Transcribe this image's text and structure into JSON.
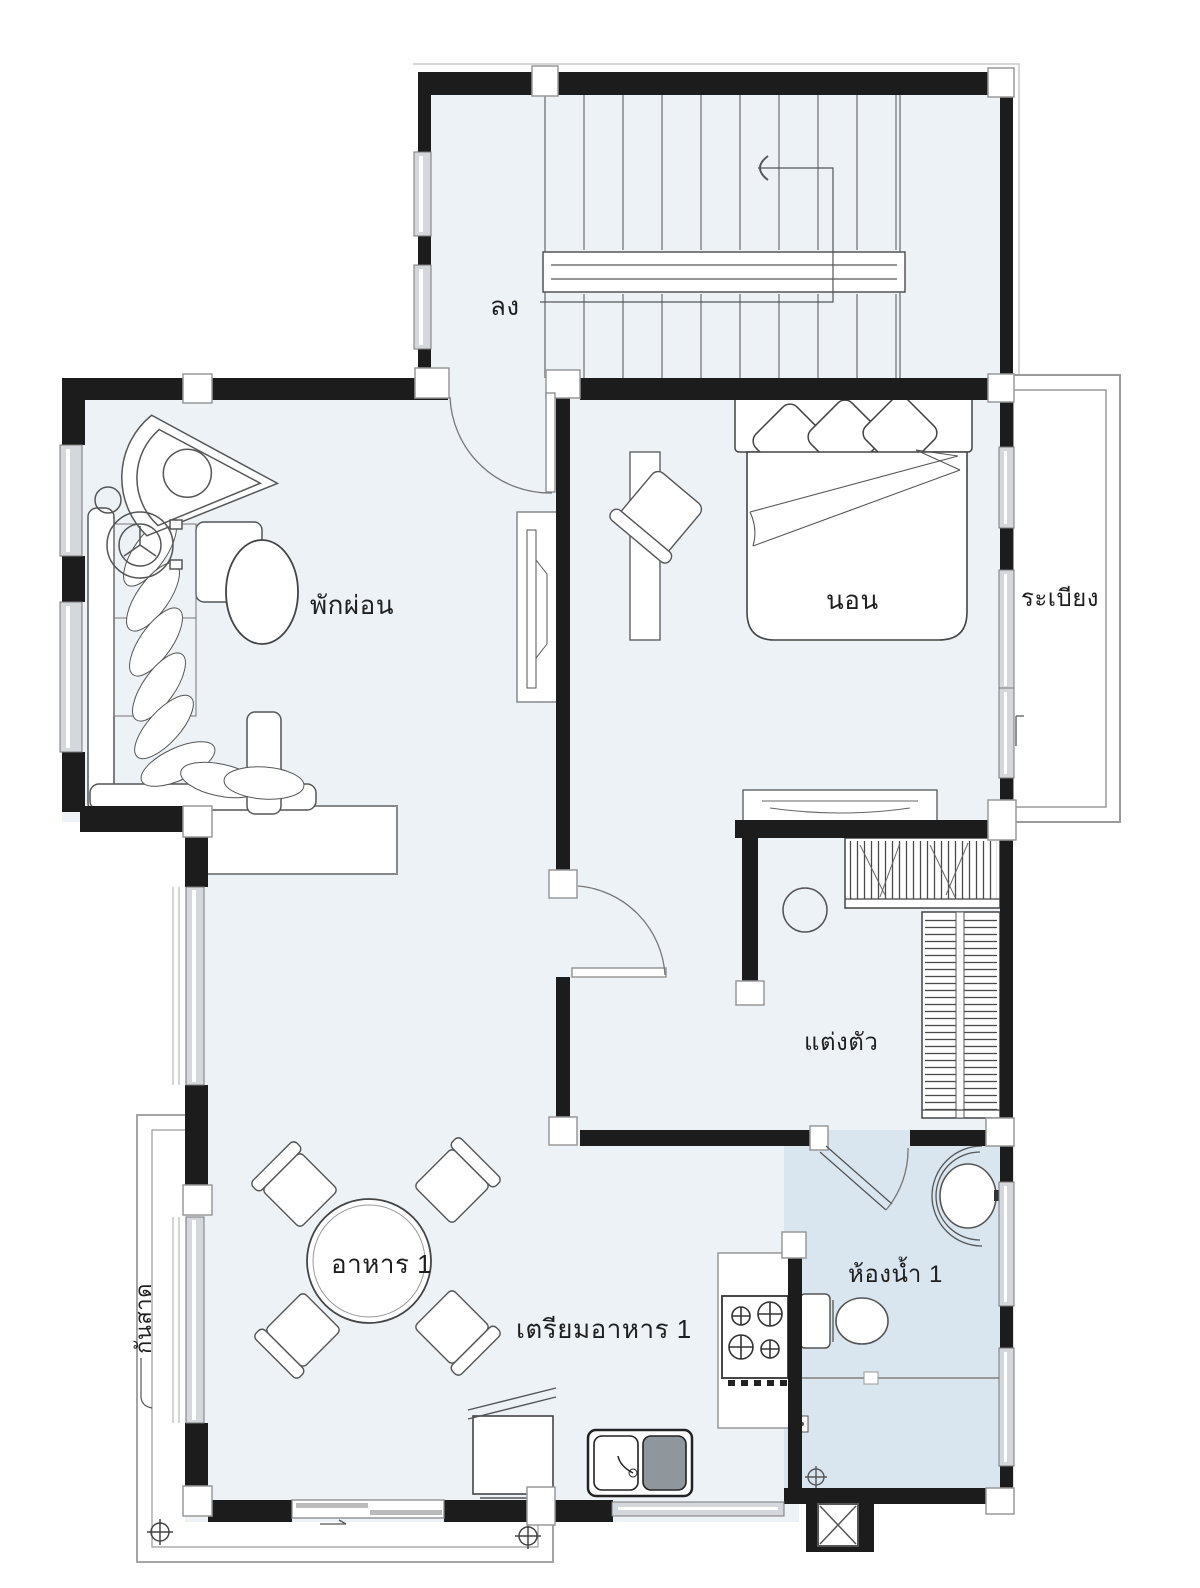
{
  "rooms": {
    "stairs": {
      "label": "ลง"
    },
    "living": {
      "label": "พักผ่อน"
    },
    "bedroom": {
      "label": "นอน"
    },
    "balcony": {
      "label": "ระเบียง"
    },
    "dressing": {
      "label": "แต่งตัว"
    },
    "dining": {
      "label": "อาหาร 1"
    },
    "kitchen": {
      "label": "เตรียมอาหาร 1"
    },
    "bathroom": {
      "label": "ห้องน้ำ 1"
    },
    "awning": {
      "label": "กันสาด"
    }
  },
  "colors": {
    "wall": "#1c1c1c",
    "floor": "#edf2f7",
    "bathroom_floor": "#d9e6f0",
    "window": "#d4d8dc",
    "line": "#555555",
    "outline": "#9a9a9a",
    "background": "#ffffff",
    "text": "#1f1f1f"
  }
}
